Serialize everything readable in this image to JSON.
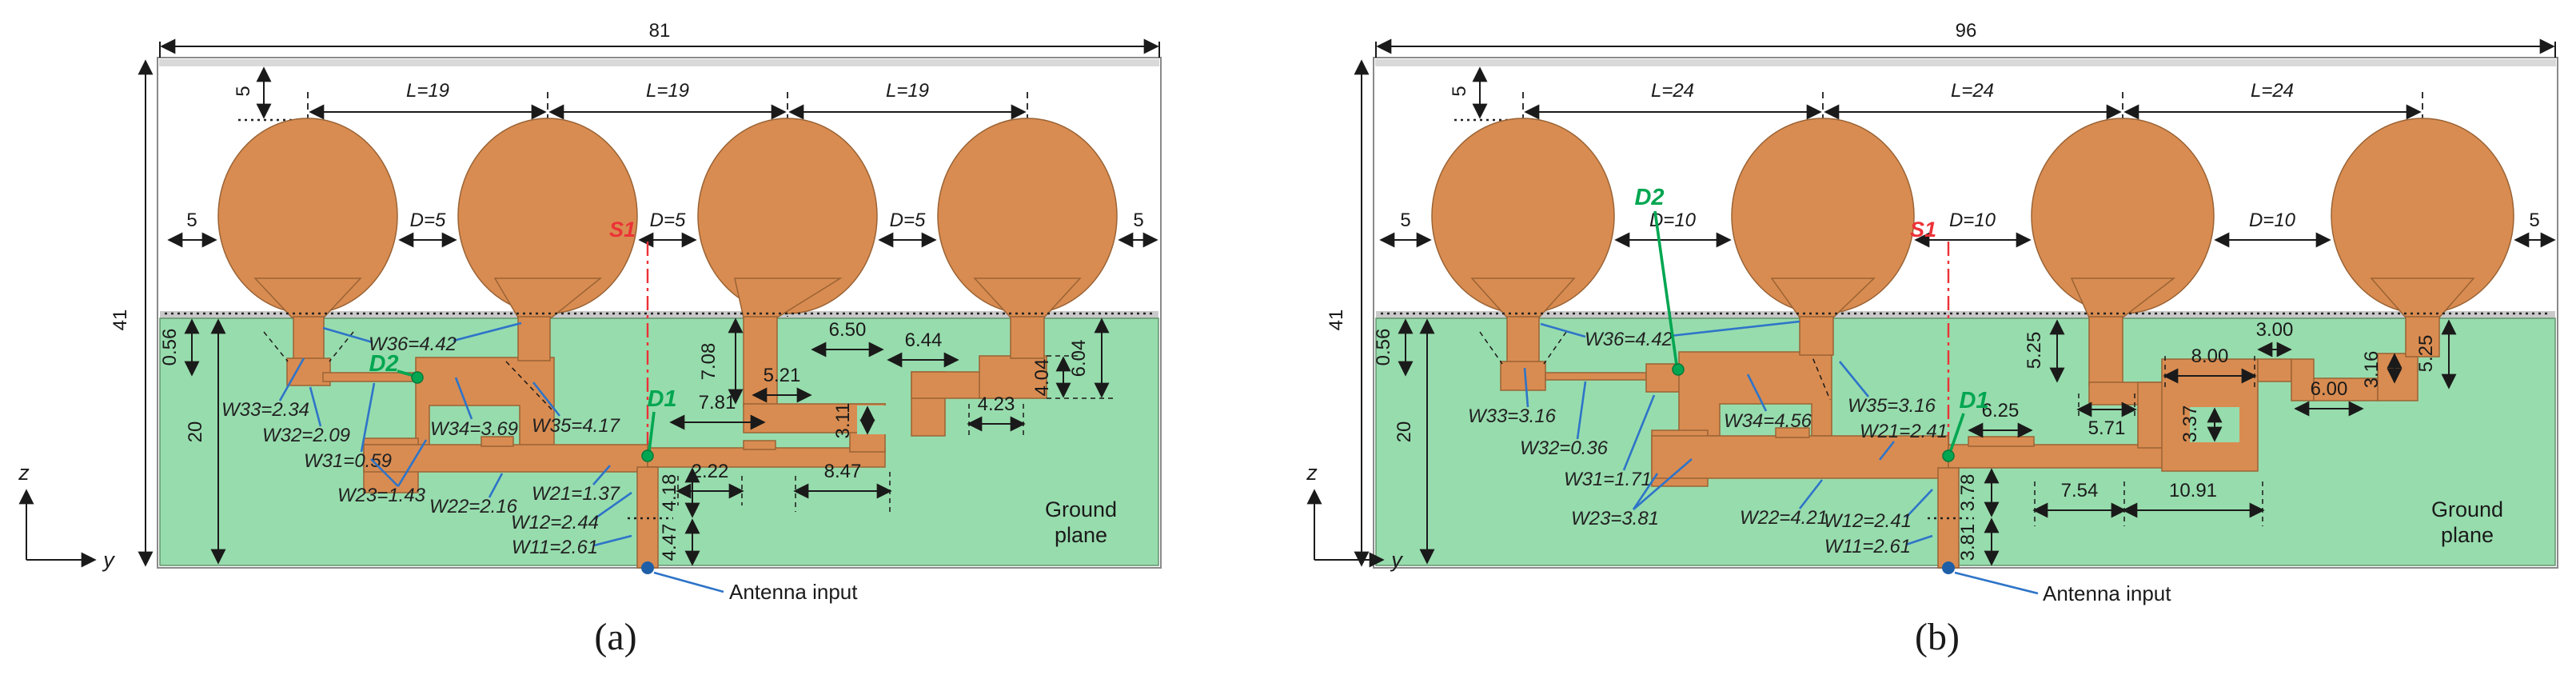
{
  "figure": {
    "description": "Geometry of two four-element elliptical patch antenna arrays with corporate feed network on ground plane",
    "colors": {
      "copper": "#D98C51",
      "ground_plane": "#97DCAD",
      "leader_line": "#2E74C8",
      "marker_green": "#00A651",
      "symmetry_red": "#EC3237"
    },
    "panels": [
      {
        "caption": "(a)",
        "board_width": "81",
        "board_height": "41",
        "top_offset": "5",
        "left_margin": "5",
        "right_margin": "5",
        "pitch": [
          "L=19",
          "L=19",
          "L=19"
        ],
        "gap": [
          "D=5",
          "D=5",
          "D=5"
        ],
        "ground_gap": "0.56",
        "ground_depth": "20",
        "s1": "S1",
        "d1": "D1",
        "d2": "D2",
        "widths": {
          "w36": "W36=4.42",
          "w33": "W33=2.34",
          "w32": "W32=2.09",
          "w31": "W31=0.59",
          "w23": "W23=1.43",
          "w34": "W34=3.69",
          "w35": "W35=4.17",
          "w22": "W22=2.16",
          "w21": "W21=1.37",
          "w12": "W12=2.44",
          "w11": "W11=2.61"
        },
        "dims": {
          "d708": "7.08",
          "d521": "5.21",
          "d650": "6.50",
          "d644": "6.44",
          "d404": "4.04",
          "d604": "6.04",
          "d423": "4.23",
          "d311": "3.11",
          "d781": "7.81",
          "d222": "2.22",
          "d847": "8.47",
          "d418": "4.18",
          "d447": "4.47"
        },
        "ground_label": [
          "Ground",
          "plane"
        ],
        "antenna_input": "Antenna input",
        "axes": {
          "vertical": "z",
          "horizontal": "y"
        }
      },
      {
        "caption": "(b)",
        "board_width": "96",
        "board_height": "41",
        "top_offset": "5",
        "left_margin": "5",
        "right_margin": "5",
        "pitch": [
          "L=24",
          "L=24",
          "L=24"
        ],
        "gap": [
          "D=10",
          "D=10",
          "D=10"
        ],
        "ground_gap": "0.56",
        "ground_depth": "20",
        "s1": "S1",
        "d1": "D1",
        "d2": "D2",
        "widths": {
          "w36": "W36=4.42",
          "w33": "W33=3.16",
          "w32": "W32=0.36",
          "w31": "W31=1.71",
          "w23": "W23=3.81",
          "w34": "W34=4.56",
          "w35": "W35=3.16",
          "w22": "W22=4.21",
          "w21": "W21=2.41",
          "w12": "W12=2.41",
          "w11": "W11=2.61"
        },
        "dims": {
          "d525L": "5.25",
          "d571": "5.71",
          "d800": "8.00",
          "d300": "3.00",
          "d337": "3.37",
          "d600": "6.00",
          "d316": "3.16",
          "d525R": "5.25",
          "d625": "6.25",
          "d754": "7.54",
          "d1091": "10.91",
          "d378": "3.78",
          "d381": "3.81"
        },
        "ground_label": [
          "Ground",
          "plane"
        ],
        "antenna_input": "Antenna input",
        "axes": {
          "vertical": "z",
          "horizontal": "y"
        }
      }
    ]
  }
}
